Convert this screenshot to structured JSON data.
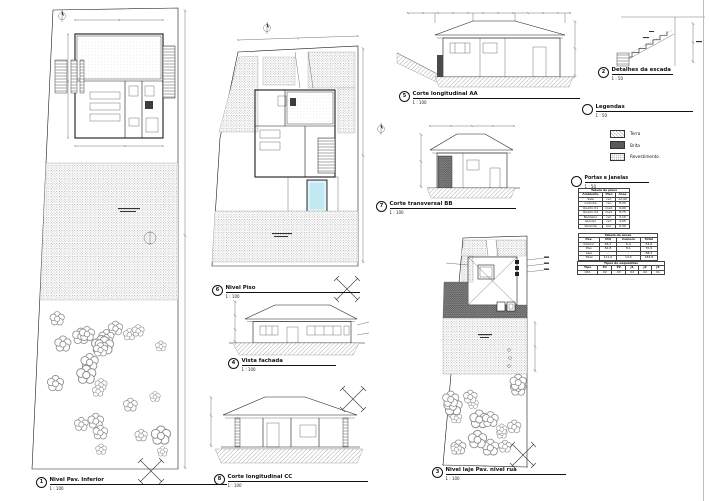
{
  "sheet": {
    "background": "#ffffff",
    "line_color": "#1a1a1a",
    "stipple_color": "#9a9a9a",
    "dark_fill_color": "#3d3d3d",
    "pool_color": "#c2e8f2"
  },
  "views": [
    {
      "num": "1",
      "title": "Nivel Pav. Inferior",
      "scale": "1 : 100"
    },
    {
      "num": "2",
      "title": "Detalhes da escada",
      "scale": "1 : 50"
    },
    {
      "num": "3",
      "title": "Nivel laje Pav. nivel rua",
      "scale": "1 : 100"
    },
    {
      "num": "4",
      "title": "Vista fachada",
      "scale": "1 : 100"
    },
    {
      "num": "5",
      "title": "Corte longitudinal AA",
      "scale": "1 : 100"
    },
    {
      "num": "6",
      "title": "Nivel Piso",
      "scale": "1 : 100"
    },
    {
      "num": "7",
      "title": "Corte transversal BB",
      "scale": "1 : 100"
    },
    {
      "num": "8",
      "title": "Corte longitudinal CC",
      "scale": "1 : 100"
    }
  ],
  "legend": {
    "title": "Legendas",
    "scale": "1 : 50",
    "items": [
      {
        "label": "Terra",
        "swatch": "hatch-light"
      },
      {
        "label": "Brita",
        "swatch": "dark-stipple"
      },
      {
        "label": "Revestimento",
        "swatch": "light-stipple"
      }
    ]
  },
  "schedules": {
    "heading": {
      "title": "Portas e Janelas",
      "scale": "1 : 50"
    },
    "tables": [
      {
        "title": "Tabela de pisos",
        "columns": [
          "Ambiente",
          "Piso",
          "Área"
        ],
        "rows": [
          [
            "Sala",
            "cer.",
            "12,40"
          ],
          [
            "Cozinha",
            "cer.",
            "8,20"
          ],
          [
            "Quarto 01",
            "mad.",
            "9,60"
          ],
          [
            "Quarto 02",
            "mad.",
            "8,75"
          ],
          [
            "Banheiro",
            "cer.",
            "3,10"
          ],
          [
            "Serviço",
            "cer.",
            "4,05"
          ],
          [
            "Varanda",
            "cim.",
            "6,30"
          ]
        ]
      },
      {
        "title": "Tabela de áreas",
        "columns": [
          "Pav.",
          "Útil",
          "Comum",
          "Total"
        ],
        "rows": [
          [
            "Inferior",
            "48,2",
            "6,4",
            "54,6"
          ],
          [
            "Piso",
            "62,8",
            "8,1",
            "70,9"
          ],
          [
            "Laje",
            "-",
            "-",
            "58,3"
          ],
          [
            "Total",
            "111,0",
            "14,5",
            "183,8"
          ]
        ]
      },
      {
        "title": "Tipos de esquadrias",
        "columns": [
          "Tipo",
          "P1",
          "P2",
          "J1",
          "J2",
          "J3"
        ],
        "rows": [
          [
            "Qtd.",
            "02",
            "03",
            "04",
            "02",
            "01"
          ]
        ]
      }
    ]
  }
}
